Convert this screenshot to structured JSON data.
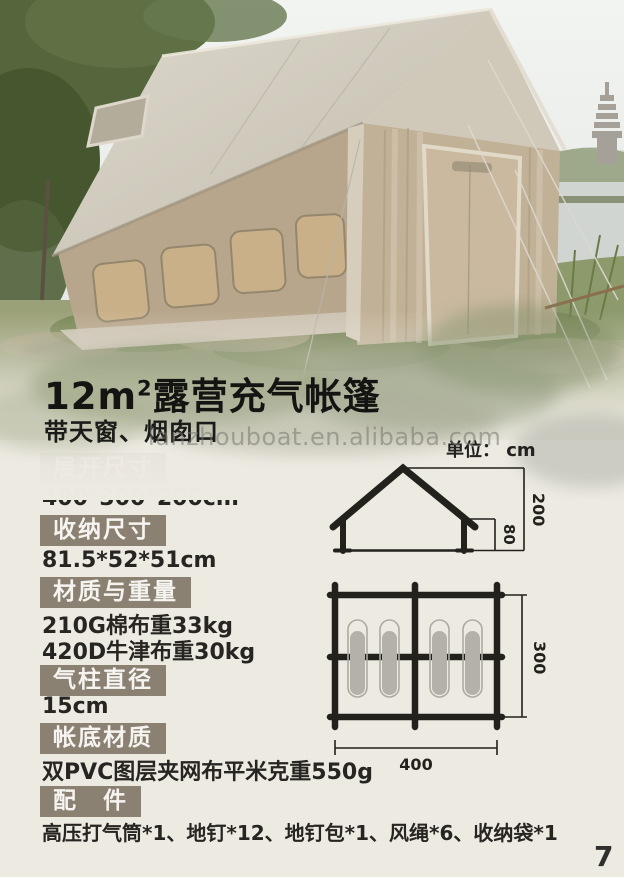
{
  "header": {
    "title_num": "12m",
    "title_sup": "2",
    "title_rest": "露营充气帐篷",
    "subtitle": "带天窗、烟囱口"
  },
  "watermark": "lanzhouboat.en.alibaba.com",
  "diagram": {
    "unit_label": "单位： cm",
    "side_view": {
      "total_height": "200",
      "wall_height": "80"
    },
    "floor_plan": {
      "width": "400",
      "depth": "300",
      "sleeping_bag_count": "4"
    }
  },
  "specs": [
    {
      "label": "展开尺寸",
      "values": [
        "400*300*200cm"
      ]
    },
    {
      "label": "收纳尺寸",
      "values": [
        "81.5*52*51cm"
      ]
    },
    {
      "label": "材质与重量",
      "values": [
        "210G棉布重33kg",
        "420D牛津布重30kg"
      ]
    },
    {
      "label": "气柱直径",
      "values": [
        "15cm"
      ]
    },
    {
      "label": "帐底材质",
      "values": [
        "双PVC图层夹网布平米克重550g"
      ]
    },
    {
      "label": "配　件",
      "values": [
        "高压打气筒*1、地钉*12、地钉包*1、风绳*6、收纳袋*1"
      ]
    }
  ],
  "page": {
    "number": "7"
  },
  "colors": {
    "label_bg": "#8b8173",
    "page_bg": "#edeae2",
    "diagram_line": "#23211c"
  }
}
